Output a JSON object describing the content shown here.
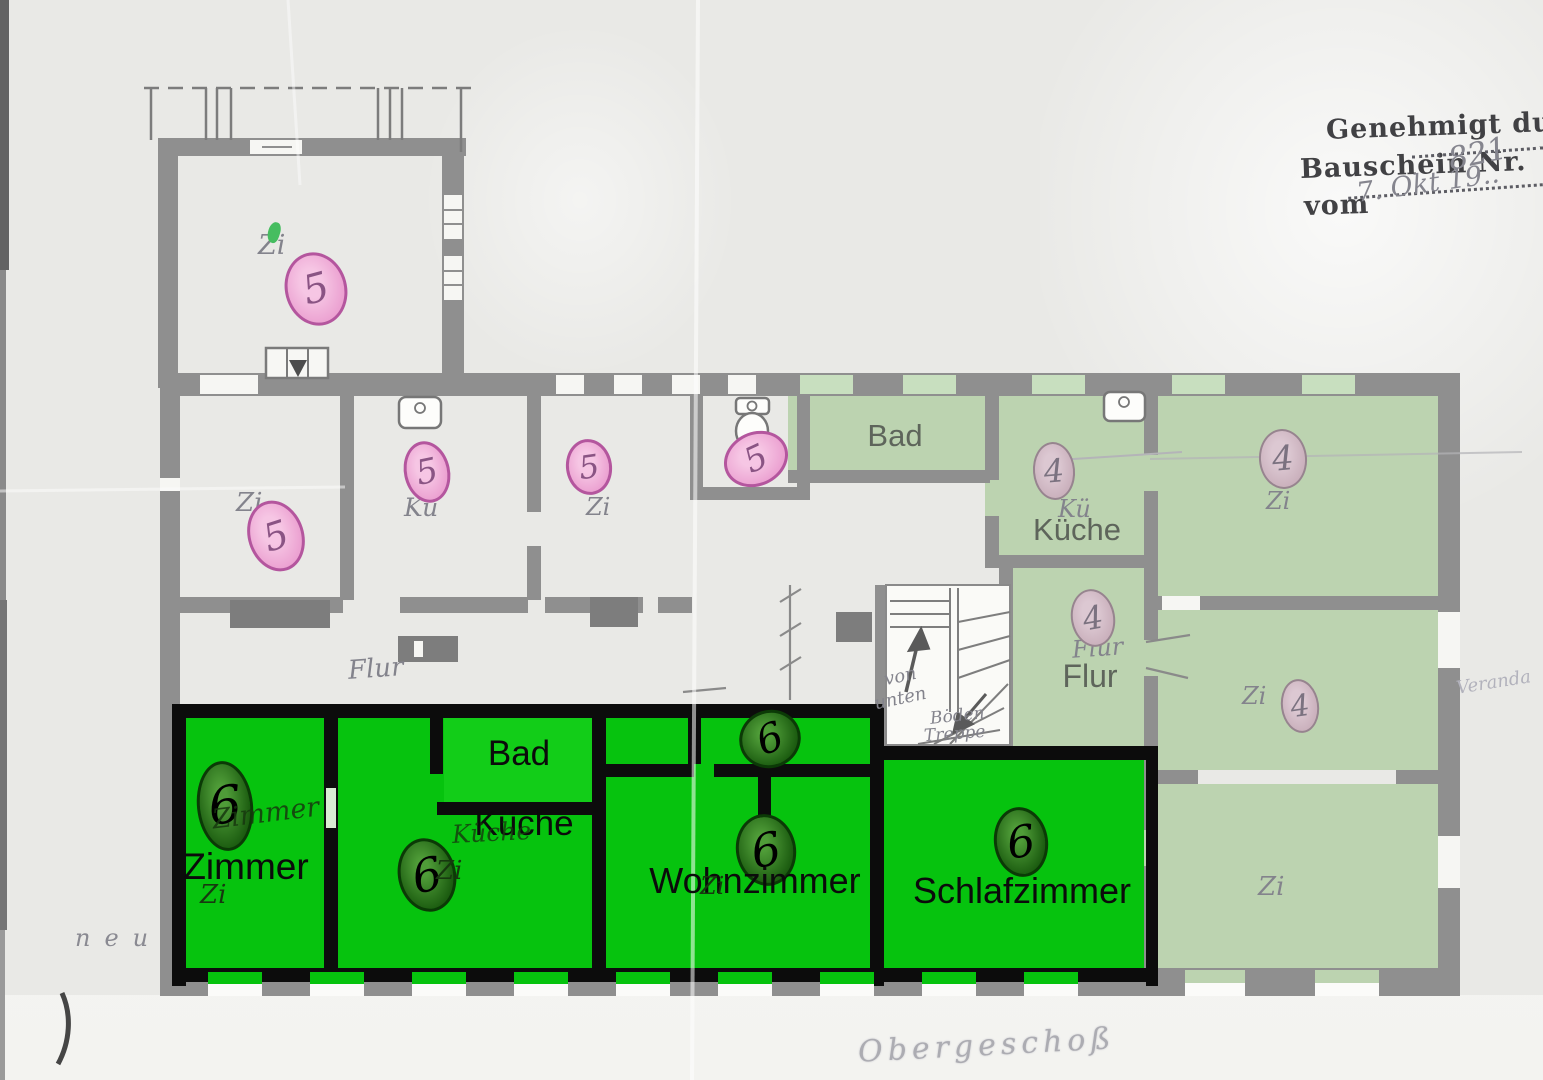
{
  "document": {
    "floor_label_hand": "Obergeschoß",
    "margin_note": "neu",
    "veranda_note": "Veranda"
  },
  "stamp": {
    "line1": "Genehmigt durch",
    "permit_label": "Bauschein Nr.",
    "permit_number": "821",
    "date_label": "vom",
    "date_value": "7. Okt 19.."
  },
  "corridor": {
    "hand": "Flur"
  },
  "stairs": {
    "from_below_line1": "von",
    "from_below_line2": "unten",
    "attic_line1": "Böden",
    "attic_line2": "Treppe"
  },
  "flat_new": {
    "unit": "6",
    "zimmer_label": "Zimmer",
    "zimmer_hand": "Zimmer",
    "zi_hand": "Zi",
    "bad_label": "Bad",
    "kueche_label": "Küche",
    "kueche_hand": "Küche",
    "wohnzimmer_label": "Wohnzimmer",
    "schlafzimmer_label": "Schlafzimmer",
    "highlight_color": "#06c30e"
  },
  "flat_left": {
    "unit": "4",
    "bad_label": "Bad",
    "kueche_label": "Küche",
    "kueche_hand": "Kü",
    "flur_label": "Flur",
    "flur_hand": "Flur",
    "zi_hand": "Zi",
    "highlight_color": "#bcd3b0"
  },
  "flat_old": {
    "unit": "5",
    "zi_hand": "Zi",
    "kueche_hand": "Kü"
  },
  "colors": {
    "wall_gray": "#8f8f8f",
    "overlay_wall_black": "#0c0c0c",
    "badge_pink": "#eca3d2",
    "badge_green": "#1e5f12"
  }
}
